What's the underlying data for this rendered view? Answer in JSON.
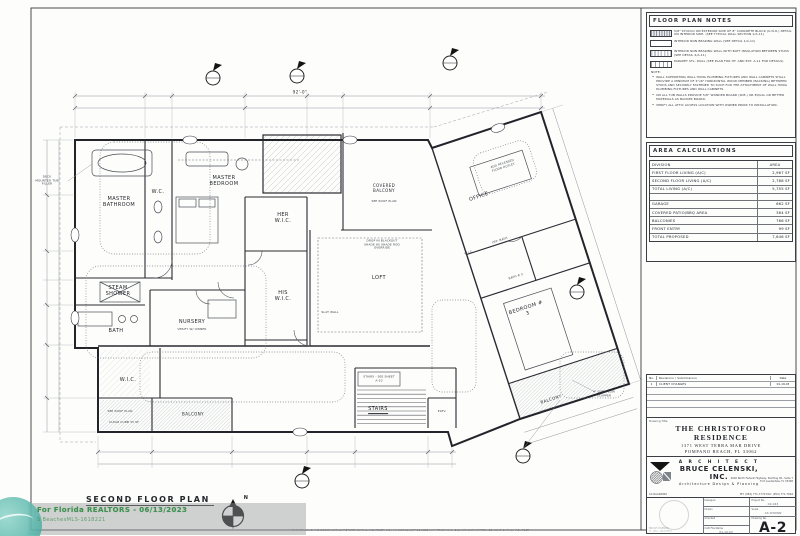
{
  "sheet": {
    "plan_title": "SECOND FLOOR PLAN",
    "copyright_line": "THIS DRAWING AND DESIGN IS THE PROPERTY OF THE ARCHITECT AND MAY NOT BE REPRODUCED IN PART OR IN WHOLE WITHOUT WRITTEN CONSENT OF THE ARCHITECT"
  },
  "watermark": {
    "line1": "For Florida REALTORS - 06/13/2023",
    "line2": "S BeachesMLS-1618221"
  },
  "notes_panel": {
    "title": "FLOOR PLAN NOTES",
    "legend": [
      "5/8\" STUCCO ON EXTERIOR SIDE OF 8\" CONCRETE BLOCK (U.N.O.) DETAIL ON INTERIOR SIDE. (SEE TYPICAL WALL SECTION 1/A-11)",
      "INTERIOR NON BEARING WALL (SEE DETAIL 1/A-11)",
      "INTERIOR NON BEARING WALL WITH BATT INSULATION BETWEEN STUDS (SEE DETAIL 2/A-11)",
      "PARAPET STL. WALL (SEE PLAN FOR HT. AND EXT. A-11 FOR DETAILS)"
    ],
    "note_label": "NOTE:",
    "notes": [
      "WALL SUPPORTING WALL HUNG PLUMBING FIXTURES AND WALL CABINETS SHALL PROVIDE A MINIMUM OF 2\"x6\" HORIZONTAL WOOD MEMBER (BACKING) BETWEEN STUDS AND SECURELY FASTENED TO SUCH FOR THE ATTACHMENT OF WALL HUNG PLUMBING FIXTURES AND WALL CABINETS.",
      "ON ALL TUB WALLS PROVIDE 5/8\" WONDER BOARD (W.B.) OR EQUAL OR BETTER MATERIALS AS BACKER BOARD.",
      "VERIFY ALL ATTIC ACCESS LOCATION WITH OWNER PRIOR TO INSTALLATION."
    ]
  },
  "area_panel": {
    "title": "AREA CALCULATIONS",
    "col_division": "DIVISION",
    "col_area": "AREA",
    "rows": [
      {
        "division": "FIRST FLOOR LIVING (A/C)",
        "area": "2,967 SF"
      },
      {
        "division": "SECOND FLOOR LIVING (A/C)",
        "area": "2,788 SF"
      },
      {
        "division": "TOTAL LIVING (A/C)",
        "area": "5,755 SF"
      },
      {
        "division": "GARAGE",
        "area": "662 SF"
      },
      {
        "division": "COVERED PATIO/BBQ AREA",
        "area": "364 SF"
      },
      {
        "division": "BALCONIES",
        "area": "766 SF"
      },
      {
        "division": "FRONT ENTRY",
        "area": "99 SF"
      },
      {
        "division": "TOTAL PROPOSED",
        "area": "7,646 SF"
      }
    ]
  },
  "revisions": {
    "col_no": "No.",
    "col_rev": "Revisions / Submissions",
    "col_date": "Date",
    "row1_no": "1",
    "row1_rev": "CLIENT CHANGES",
    "row1_date": "01-19-03"
  },
  "title_block": {
    "drawing_title_label": "Drawing Title",
    "project_name": "THE CHRISTOFORO RESIDENCE",
    "address1": "1371 WEST TERRA MAR DRIVE",
    "address2": "POMPANO BEACH, FL  33062",
    "architect_label": "A R C H I T E C T",
    "firm": "BRUCE CELENSKI, INC.",
    "firm_sub": "Architecture   Design   &   Planning",
    "firm_addr1": "2640 North Federal Highway, Building #1, Suite 7",
    "firm_addr2": "Fort Lauderdale, FL 33308",
    "license": "CA RAA26000",
    "phone": "PH: (954) 771-7770   FAX: (954) 771-7064",
    "seal_name": "BRUCE CELENSKI",
    "seal_sub": "FL. REG. ARCHITECT",
    "designer_label": "Designer",
    "drawn_label": "Drawn",
    "checked_label": "Checked",
    "cad_label": "CAD File Name",
    "cad_value": "01-19-03",
    "project_no_label": "Project No.",
    "project_no_value": "02-043",
    "scale_label": "Scale",
    "scale_value": "AS SHOWN",
    "drawing_no_label": "Drawing No.",
    "drawing_no_value": "A-2"
  },
  "plan": {
    "labels": {
      "master_bathroom": "MASTER BATHROOM",
      "wc": "W.C.",
      "master_bedroom": "MASTER BEDROOM",
      "her_wic": "HER W.I.C.",
      "his_wic": "HIS W.I.C.",
      "covered_balcony": "COVERED BALCONY",
      "see_roof_plan": "SEE ROOF PLAN",
      "loft": "LOFT",
      "office": "OFFICE",
      "office_bath": "OFF. BATH",
      "office_wic": "W.I.C.",
      "bath_3": "BATH # 3",
      "bedroom_3": "BEDROOM # 3",
      "steam_shower": "STEAM SHOWER",
      "bath": "BATH",
      "nursery": "NURSERY",
      "nursery_note": "VERIFY W/ OWNER",
      "wic": "W.I.C.",
      "balcony": "BALCONY",
      "stairs": "STAIRS",
      "stairs_note": "STAIRS - SEE SHEET A-10",
      "elevator": "ELEV.",
      "slat_wall": "SLAT WALL",
      "clear_curb": "CLEAR CURB 35 SF",
      "blackout_note": "DROP IN BLACKOUT SHADE W/ SHADE ROD OVERRIDE",
      "floor_outlet_note": "ADD RECESSED FLOOR OUTLET",
      "scupper_note": "4\" OVERFLOW SCUPPER",
      "tub_filler_note": "DECK MOUNTED TUB FILLER",
      "dim_92": "92'-0\"",
      "north": "N"
    }
  }
}
